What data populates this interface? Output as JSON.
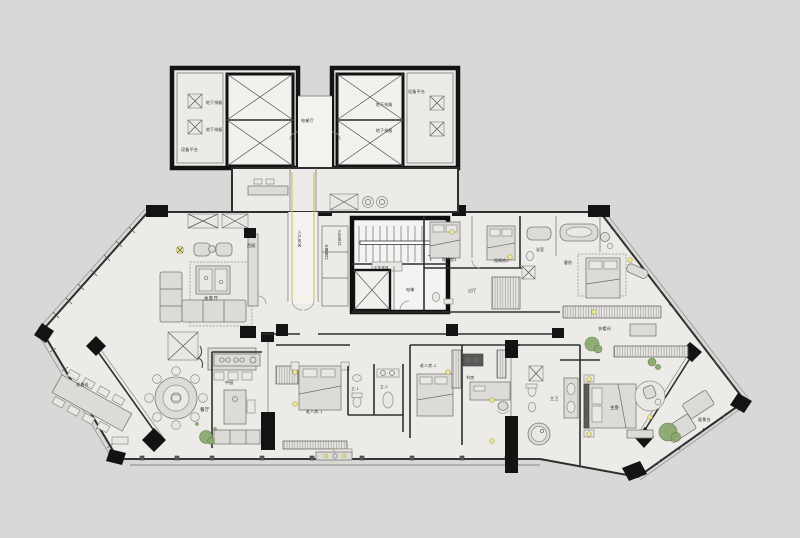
{
  "meta": {
    "type": "architectural-floor-plan",
    "background": "#d8d8d6",
    "floor_fill": "#ecebe8",
    "wall_color": "#131313",
    "accent_yellow": "#ebe69b",
    "plant_green": "#8aa86d",
    "entry_guide_yellow": "#cdbf5c"
  },
  "labels": {
    "equip_platform": "设备平台",
    "underground_vent": "地下排烟",
    "elevator_hall": "电梯厅",
    "entry_foyer": "入户玄关",
    "plumbing_shaft": "水暖管井",
    "pressure_shaft": "正压风井",
    "pressure_supply": "正压送风",
    "up": "上",
    "down": "下",
    "elevator": "电梯",
    "living": "会客厅",
    "pantry": "西厨",
    "dining": "餐厅",
    "kitchen": "中厨",
    "maid_room_1": "保姆房1",
    "maid_room_2": "保姆房2",
    "hall": "过厅",
    "bath": "浴室",
    "guest_bedroom": "客卧",
    "elder_room_1": "老人房-1",
    "elder_room_2": "老人房-2",
    "wc1": "卫-1",
    "wc2": "卫-2",
    "study": "书房",
    "master_bath": "主卫",
    "master_bedroom": "主卧",
    "cloakroom": "衣帽间",
    "view_terrace": "观景台"
  }
}
